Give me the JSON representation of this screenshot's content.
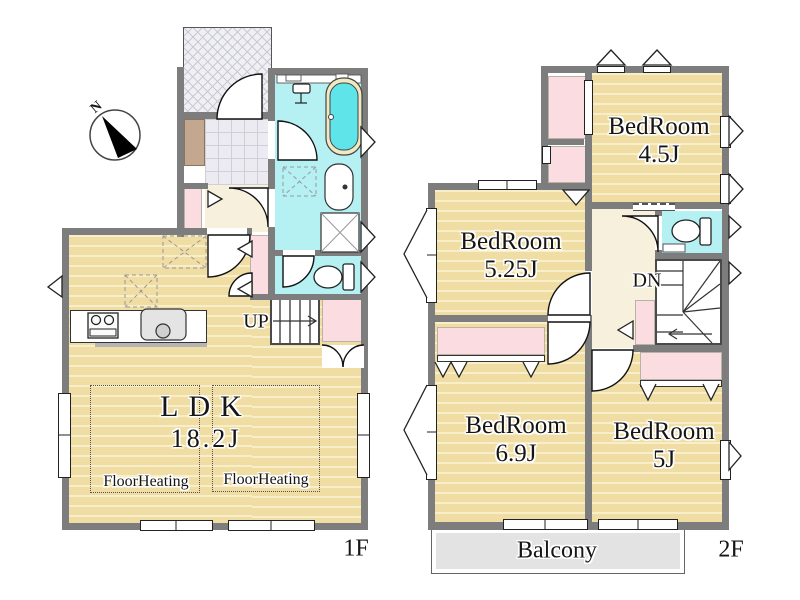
{
  "compass": {
    "north_label": "N"
  },
  "floor1": {
    "floor_label": "1F",
    "ldk": {
      "name": "LDK",
      "size": "18.2J"
    },
    "floor_heating_left": "FloorHeating",
    "floor_heating_right": "FloorHeating",
    "stairs_label": "UP"
  },
  "floor2": {
    "floor_label": "2F",
    "bedroom_45": {
      "name": "BedRoom",
      "size": "4.5J"
    },
    "bedroom_525": {
      "name": "BedRoom",
      "size": "5.25J"
    },
    "bedroom_69": {
      "name": "BedRoom",
      "size": "6.9J"
    },
    "bedroom_5": {
      "name": "BedRoom",
      "size": "5J"
    },
    "stairs_label": "DN",
    "balcony_label": "Balcony"
  },
  "colors": {
    "wall": "#7d7d7d",
    "wood_floor": "#f0dda4",
    "wet_room": "#b5f0f2",
    "bathtub_water": "#5fe4ea",
    "closet_pink": "#fbdce0",
    "hallway_cream": "#f7f0dc",
    "balcony_gray": "#e3e3e3"
  }
}
